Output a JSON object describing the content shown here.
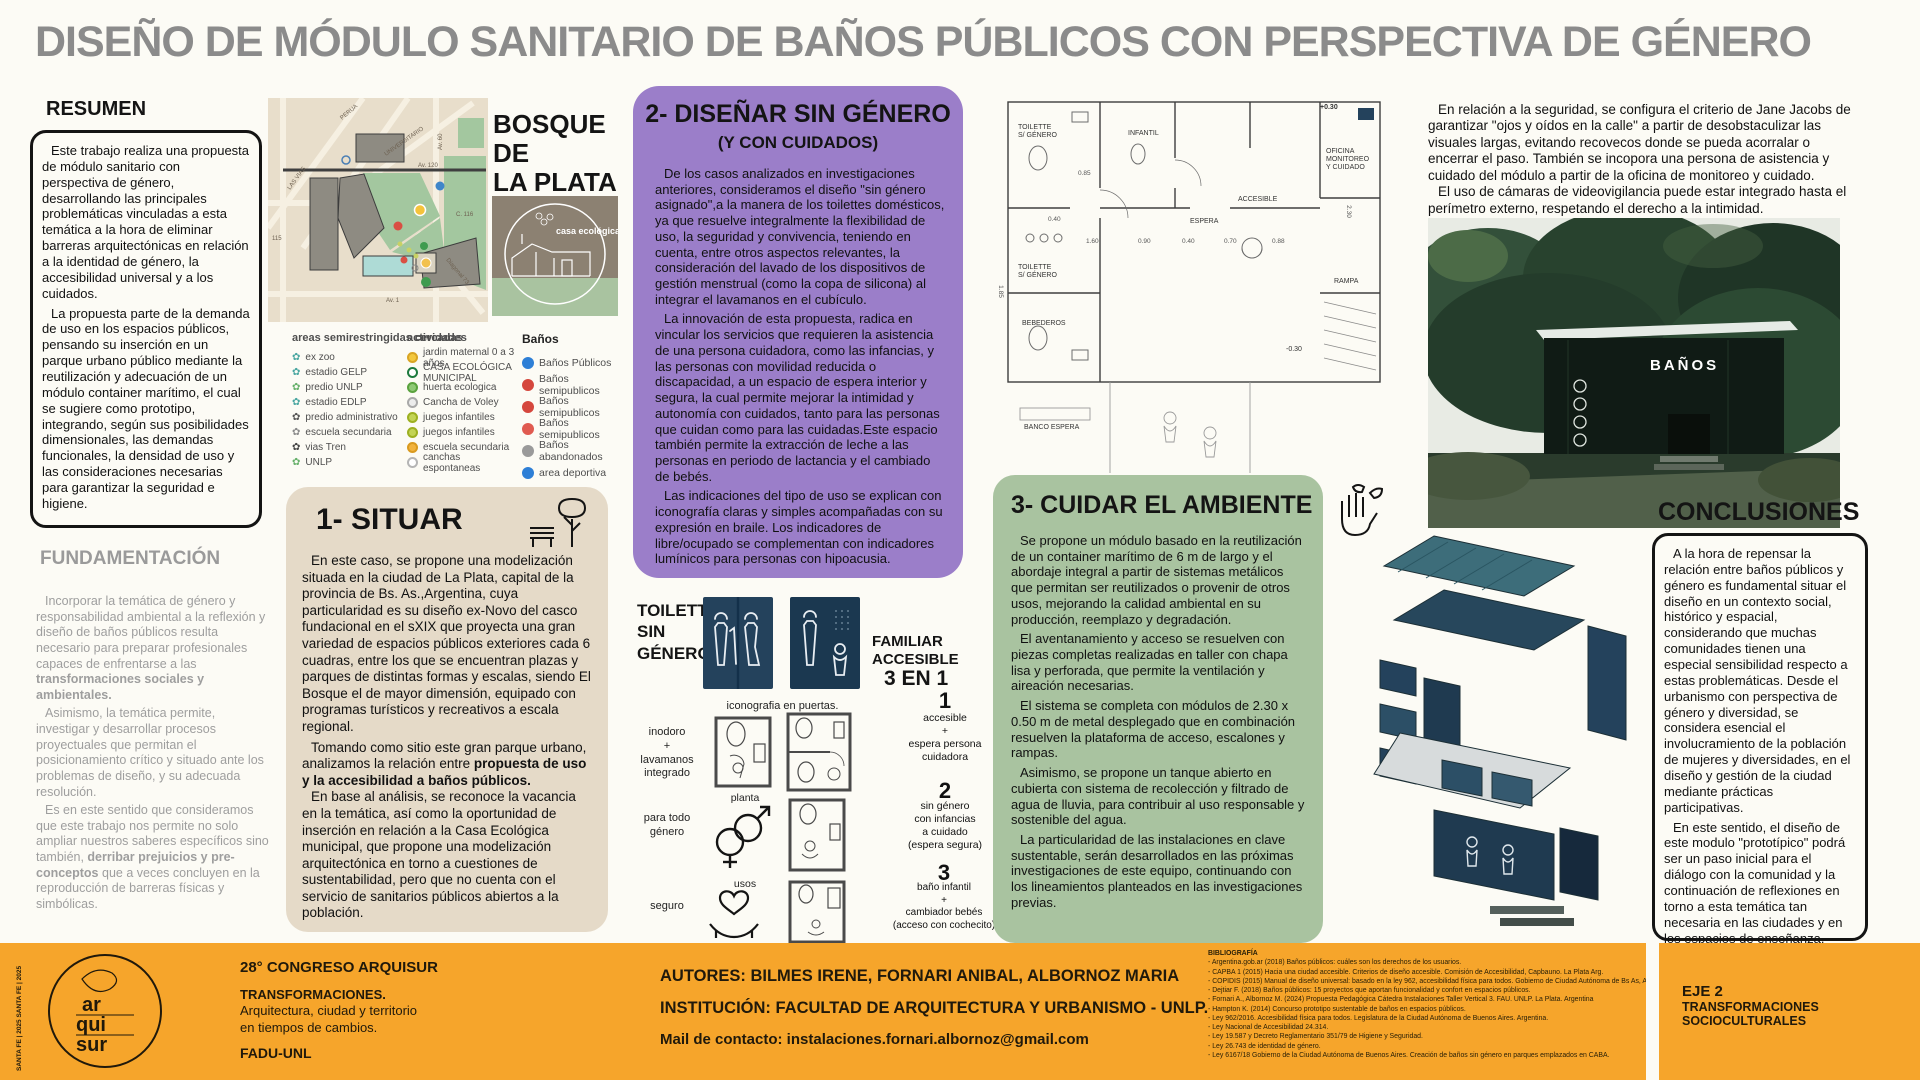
{
  "palette": {
    "accent_purple": "#9b7ec9",
    "accent_beige": "#e5dac8",
    "accent_green": "#a9c3a0",
    "accent_orange": "#f6a52b",
    "door_navy": "#24425c",
    "title_gray": "#8b8b8b"
  },
  "title": "DISEÑO DE MÓDULO SANITARIO DE BAÑOS PÚBLICOS CON PERSPECTIVA DE GÉNERO",
  "resumen": {
    "heading": "RESUMEN",
    "p1": "Este trabajo realiza una propuesta de módulo sanitario con perspectiva de género, desarrollando las principales problemáticas vinculadas a esta temática a la hora de eliminar barreras arquitectónicas en relación a la identidad de género, la accesibilidad universal y a los cuidados.",
    "p2": "La propuesta parte de la demanda de uso en los espacios públicos, pensando su inserción en un parque urbano público mediante la reutilización y adecuación de un módulo container marítimo, el cual se sugiere como prototipo, integrando, según sus posibilidades dimensionales, las demandas funcionales, la densidad de uso y las consideraciones necesarias para garantizar la seguridad e higiene."
  },
  "fundamentacion": {
    "heading": "FUNDAMENTACIÓN",
    "p1a": "Incorporar la temática de género y responsabilidad ambiental a la reflexión y diseño de baños públicos resulta necesario para preparar profesionales capaces de enfrentarse a las ",
    "p1b": "transformaciones sociales y ambientales.",
    "p2": "Asimismo, la temática permite, investigar y desarrollar procesos proyectuales que permitan el posicionamiento crítico y situado ante los problemas de diseño, y su adecuada resolución.",
    "p3a": "Es en este sentido que consideramos que este trabajo nos permite no solo ampliar nuestros saberes específicos sino también, ",
    "p3b": "derribar prejuicios y pre-conceptos",
    "p3c": " que a veces concluyen en la reproducción de barreras físicas y simbólicas."
  },
  "map": {
    "title": "BOSQUE\nDE\nLA PLATA",
    "casa_label": "casa\necológica",
    "street_labels": [
      "LAS VIAS",
      "PERUA",
      "UNIVERSITARIO",
      "Av. 120",
      "115",
      "C. 116",
      "Av. 60",
      "Diagonal 73",
      "Av. 1"
    ]
  },
  "legend": {
    "areas": {
      "heading": "areas semirestringidas cercadas",
      "items": [
        "ex zoo",
        "estadio GELP",
        "predio UNLP",
        "estadio EDLP",
        "predio administrativo",
        "escuela secundaria",
        "vias Tren",
        "UNLP"
      ]
    },
    "actividades": {
      "heading": "actividades",
      "items": [
        "jardin maternal 0 a 3 años",
        "CASA ECOLÓGICA MUNICIPAL",
        "huerta ecologica",
        "Cancha de Voley",
        "juegos infantiles",
        "juegos infantiles",
        "escuela secundaria",
        "canchas espontaneas"
      ]
    },
    "banos": {
      "heading": "Baños",
      "items": [
        "Baños Públicos",
        "Baños semipublicos",
        "Baños semipublicos",
        "Baños semipublicos",
        "Baños abandonados",
        "area deportiva"
      ]
    }
  },
  "situar": {
    "heading": "1- SITUAR",
    "p1": "En este caso, se propone una modelización situada en la ciudad de La Plata, capital de la provincia de Bs. As.,Argentina, cuya particularidad es su diseño ex-Novo del casco fundacional en el sXIX que proyecta una gran variedad de espacios públicos exteriores cada 6 cuadras, entre los que se encuentran plazas y parques de distintas formas y escalas, siendo El Bosque el de mayor dimensión, equipado con programas turísticos y recreativos a escala regional.",
    "p2a": "Tomando como sitio este gran parque urbano, analizamos la relación entre ",
    "p2b": "propuesta de uso y la accesibilidad a baños públicos.",
    "p3": "En base al análisis, se reconoce la vacancia en la temática, así como la oportunidad de inserción en relación a la Casa Ecológica municipal, que propone una modelización arquitectónica en torno a cuestiones de sustentabilidad, pero que no cuenta con el servicio de sanitarios públicos abiertos a la población."
  },
  "disenar": {
    "heading": "2- DISEÑAR SIN GÉNERO",
    "subheading": "(Y CON CUIDADOS)",
    "p1": "De los casos analizados en investigaciones anteriores, consideramos el diseño \"sin género asignado\",a la manera de los toilettes domésticos, ya que resuelve integralmente la flexibilidad de uso, la seguridad y convivencia, teniendo en cuenta, entre otros aspectos relevantes, la consideración del lavado de los dispositivos de gestión menstrual (como la copa de silicona) al integrar el lavamanos en el cubículo.",
    "p2": "La innovación de esta propuesta, radica en vincular los servicios que requieren la asistencia de una persona cuidadora, como las infancias, y las personas con movilidad reducida o discapacidad, a un espacio de espera interior y segura, la cual permite mejorar la intimidad y autonomía con cuidados, tanto para las personas que cuidan como para las cuidadas.Este espacio también permite la extracción de leche a las personas en periodo de lactancia y el cambiado de bebés.",
    "p3": "Las indicaciones del tipo de uso se explican con iconografía claras y simples acompañadas con su expresión en braile. Los indicadores de libre/ocupado se complementan con indicadores lumínicos para personas con hipoacusia."
  },
  "toilette": {
    "label": "TOILETTE\nSIN\nGÉNERO",
    "familiar": "FAMILIAR\nACCESIBLE",
    "three_in_one": "3 EN 1",
    "caption": "iconografia en puertas.",
    "row1_label": "inodoro\n+\nlavamanos\nintegrado",
    "planta_label": "planta",
    "row2_label": "para todo\ngénero",
    "usos_label": "usos",
    "row3_label": "seguro",
    "items": [
      {
        "num": "1",
        "label": "accesible\n+\nespera persona\ncuidadora"
      },
      {
        "num": "2",
        "label": "sin género\ncon infancias\na cuidado\n(espera segura)"
      },
      {
        "num": "3",
        "label": "baño infantil\n+\ncambiador bebés\n(acceso con cochecito)"
      }
    ]
  },
  "cuidar": {
    "heading": "3- CUIDAR EL AMBIENTE",
    "p1": "Se propone un módulo basado en la reutilización de un container marítimo de 6 m de largo y el abordaje integral a partir de sistemas metálicos que permitan ser reutilizados o provenir de otros usos, mejorando la calidad ambiental en su producción, reemplazo y degradación.",
    "p2": "El aventanamiento y acceso se resuelven con piezas completas realizadas en taller con chapa lisa y perforada, que permite la ventilación y aireación necesarias.",
    "p3": "El sistema se completa con módulos de 2.30 x 0.50 m de metal desplegado que en combinación resuelven la plataforma de acceso, escalones y rampas.",
    "p4": "Asimismo, se propone un tanque abierto en cubierta con sistema de recolección y filtrado de agua de lluvia, para contribuir al uso responsable y sostenible del agua.",
    "p5": "La particularidad de las instalaciones en clave sustentable, serán desarrollados en las próximas investigaciones de este equipo, continuando con los lineamientos planteados en las investigaciones previas."
  },
  "seguridad": {
    "p1": "En relación a la seguridad, se configura el criterio de Jane Jacobs de garantizar \"ojos y oídos en la calle\" a partir de desobstaculizar las visuales largas, evitando recovecos donde se pueda acorralar o encerrar el paso. También se incopora una persona de asistencia y cuidado del módulo a partir de la oficina de monitoreo y cuidado.",
    "p2": "El uso de cámaras de videovigilancia puede estar integrado hasta el perímetro externo, respetando el derecho a la intimidad."
  },
  "render": {
    "sign": "BAÑOS"
  },
  "conclusiones": {
    "heading": "CONCLUSIONES",
    "p1": "A la hora de repensar la relación entre baños públicos y género es fundamental situar el diseño en un contexto social, histórico y espacial, considerando que muchas comunidades tienen una especial sensibilidad respecto a estas problemáticas. Desde el urbanismo con perspectiva de género y diversidad, se considera esencial el involucramiento de la población de mujeres y diversidades, en el diseño y gestión de la ciudad mediante prácticas participativas.",
    "p2": "En este sentido, el diseño de este modulo \"prototípico\" podrá ser un paso inicial para el diálogo con la comunidad y la continuación de reflexiones en torno a esta temática tan necesaria en las ciudades y en los espacios de enseñanza."
  },
  "floorplan": {
    "labels": [
      "+0.30",
      "TOILETTE\nS/ GÉNERO",
      "INFANTIL",
      "OFICINA\nMONITOREO\nY CUIDADO",
      "ESPERA",
      "ACCESIBLE",
      "TOILETTE\nS/ GÉNERO",
      "BEBEDEROS",
      "RAMPA",
      "BANCO ESPERA",
      "-0.30"
    ],
    "dims": [
      "0.85",
      "0.40",
      "1.60",
      "0.90",
      "0.40",
      "0.70",
      "0.88",
      "2.30",
      "1.85"
    ]
  },
  "footer": {
    "stamp": "SANTA FE | 2025 SANTA FE | 2025",
    "logo": "ar\nqui\nsur",
    "congress": "28° CONGRESO ARQUISUR",
    "theme_bold": "TRANSFORMACIONES.",
    "theme_l2": "Arquitectura, ciudad y territorio",
    "theme_l3": "en tiempos de cambios.",
    "org": "FADU-UNL",
    "authors": "AUTORES: BILMES IRENE, FORNARI ANIBAL, ALBORNOZ MARIA",
    "institution": "INSTITUCIÓN: FACULTAD DE ARQUITECTURA Y URBANISMO - UNLP.",
    "mail": "Mail de contacto: instalaciones.fornari.albornoz@gmail.com",
    "biblio_heading": "BIBLIOGRAFÍA",
    "biblio": [
      "- Argentina.gob.ar (2018) Baños públicos: cuáles son los derechos de los usuarios.",
      "- CAPBA 1 (2015) Hacia una ciudad accesible. Criterios de diseño accesible. Comisión de Accesibilidad, Capbauno. La Plata Arg.",
      "- COPIDIS (2015) Manual de diseño universal: basado en la ley 962, accesibilidad física para todos. Gobierno de Ciudad Autónoma de Bs As, Arg.",
      "- Dejtiar F. (2018) Baños públicos: 15 proyectos que aportan funcionalidad y confort en espacios públicos.",
      "- Fornari A., Albornoz M. (2024) Propuesta Pedagógica Cátedra Instalaciones Taller Vertical 3. FAU. UNLP. La Plata. Argentina",
      "- Hampton K. (2014) Concurso prototipo sustentable de baños en espacios públicos.",
      "- Ley 962/2016. Accesibilidad física para todos. Legislatura de la Ciudad Autónoma de Buenos Aires. Argentina.",
      "- Ley Nacional de Accesibilidad 24.314.",
      "- Ley 19.587 y Decreto Reglamentario 351/79 de Higiene y Seguridad.",
      "- Ley 26.743 de identidad de género.",
      "- Ley 6167/18 Gobierno de la Ciudad Autónoma de Buenos Aires. Creación de baños sin género en parques emplazados en CABA."
    ],
    "eje_line1": "EJE 2",
    "eje_line2": "TRANSFORMACIONES",
    "eje_line3": "SOCIOCULTURALES"
  }
}
